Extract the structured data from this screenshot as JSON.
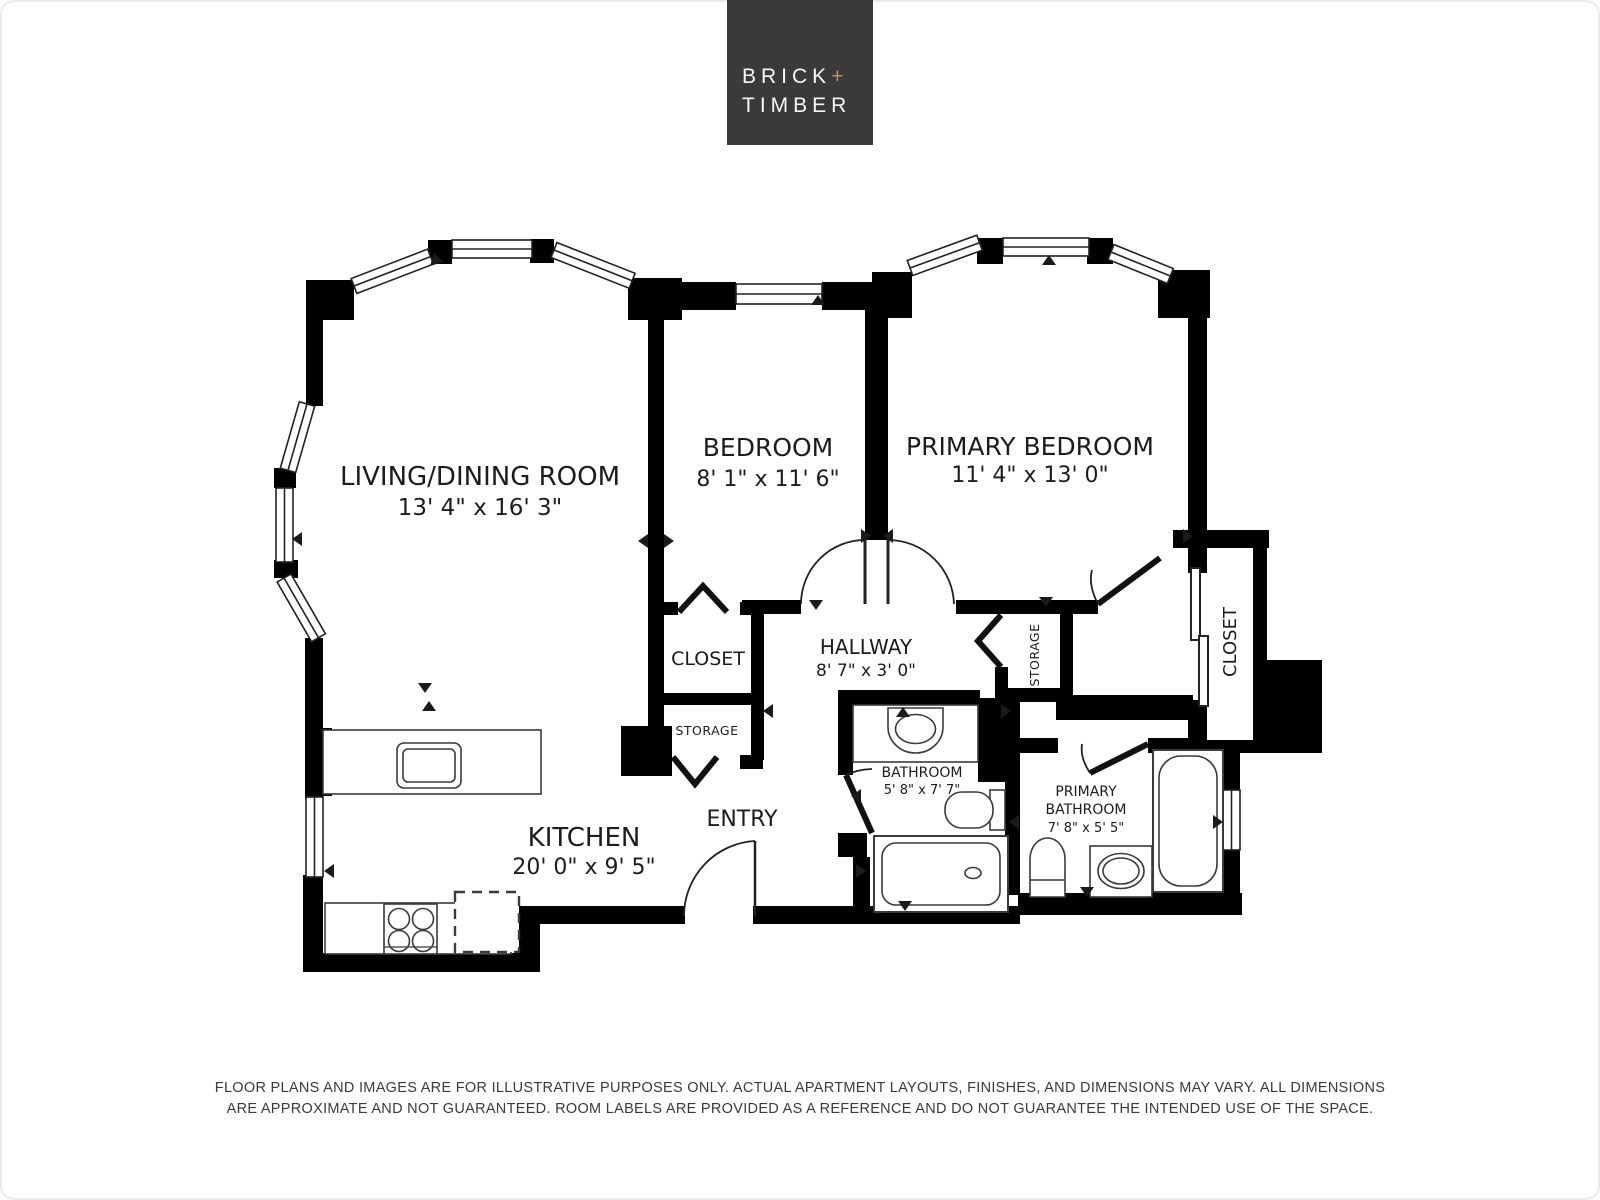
{
  "logo": {
    "brick": "BRICK",
    "plus": "+",
    "timber": "TIMBER",
    "bg_color": "#3b3a39",
    "plus_color": "#c08a6b"
  },
  "rooms": {
    "living": {
      "name": "LIVING/DINING ROOM",
      "dims": "13' 4\" x 16' 3\""
    },
    "bedroom": {
      "name": "BEDROOM",
      "dims": "8' 1\" x 11' 6\""
    },
    "primary_bedroom": {
      "name": "PRIMARY BEDROOM",
      "dims": "11' 4\" x 13' 0\""
    },
    "closet_mid": {
      "name": "CLOSET"
    },
    "storage_mid": {
      "name": "STORAGE"
    },
    "hallway": {
      "name": "HALLWAY",
      "dims": "8' 7\" x 3' 0\""
    },
    "storage_right": {
      "name": "STORAGE"
    },
    "closet_right": {
      "name": "CLOSET"
    },
    "bathroom": {
      "name": "BATHROOM",
      "dims": "5' 8\" x 7' 7\""
    },
    "primary_bathroom": {
      "name_line1": "PRIMARY",
      "name_line2": "BATHROOM",
      "dims": "7' 8\" x 5' 5\""
    },
    "kitchen": {
      "name": "KITCHEN",
      "dims": "20' 0\" x 9' 5\""
    },
    "entry": {
      "name": "ENTRY"
    }
  },
  "fixtures": [
    "kitchen-island-sink",
    "stove",
    "refrigerator-dashed",
    "bathroom-sink",
    "toilet",
    "bathtub",
    "primary-toilet",
    "primary-sink",
    "primary-bathtub"
  ],
  "colors": {
    "wall": "#000000",
    "background": "#ffffff",
    "line": "#222222"
  },
  "disclaimer": {
    "line1": "FLOOR PLANS AND IMAGES ARE FOR ILLUSTRATIVE PURPOSES ONLY. ACTUAL APARTMENT LAYOUTS, FINISHES, AND DIMENSIONS MAY VARY. ALL DIMENSIONS",
    "line2": "ARE APPROXIMATE AND NOT GUARANTEED. ROOM LABELS ARE PROVIDED AS A REFERENCE AND DO NOT GUARANTEE THE INTENDED USE OF THE SPACE."
  }
}
